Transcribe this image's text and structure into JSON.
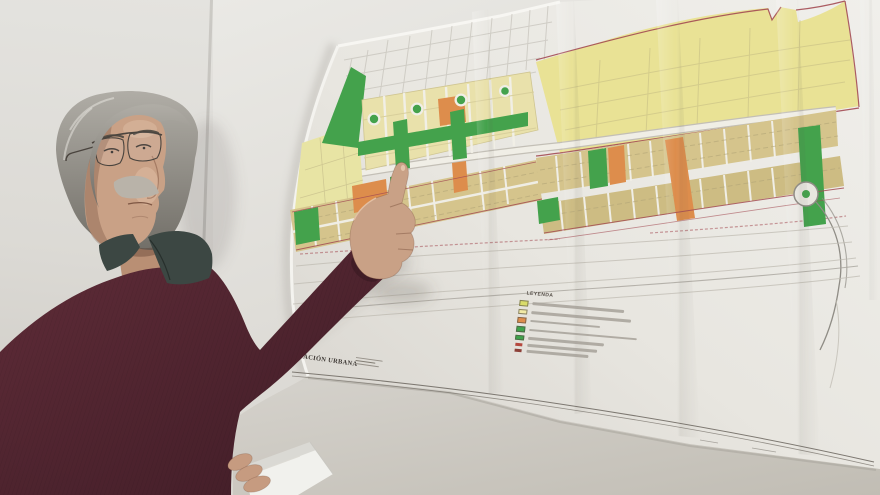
{
  "map": {
    "caption": "ORDENACIÓN URBANA",
    "legend": {
      "title": "LEYENDA",
      "items": [
        {
          "swatch": "#d9dc6a",
          "type": "fill",
          "label_w": 92
        },
        {
          "swatch": "#f2eaa6",
          "type": "fill",
          "label_w": 100
        },
        {
          "swatch": "#de8d4c",
          "type": "fill",
          "label_w": 70
        },
        {
          "swatch": "#3fa34b",
          "type": "fill",
          "label_w": 108
        },
        {
          "swatch": "#3fa34b",
          "type": "fill",
          "label_w": 76
        },
        {
          "swatch": "#b5493f",
          "type": "mark",
          "label_w": 70
        },
        {
          "swatch": "#8d4038",
          "type": "mark",
          "label_w": 62
        }
      ]
    },
    "palette": {
      "pale_yellow_zone": "#e9e295",
      "cream_blocks": "#e9e1ab",
      "tan_blocks": "#d5c48c",
      "tan_blocks_dark": "#cdbc83",
      "green_space": "#44a24c",
      "orange_blocks": "#dd8d4c",
      "red_boundary": "#a34b53",
      "road_white": "#f0eee6",
      "contour_gray": "#bfbbb2"
    }
  },
  "photo": {
    "wall_color": "#dedcd7",
    "paper_color": "#eceae4",
    "sweater_color": "#542632",
    "shirt_collar_color": "#3c4743",
    "skin_color": "#c9a186",
    "skin_shadow": "#a57e66",
    "hair_color": "#9b9891",
    "mustache_color": "#b9b3a9"
  }
}
